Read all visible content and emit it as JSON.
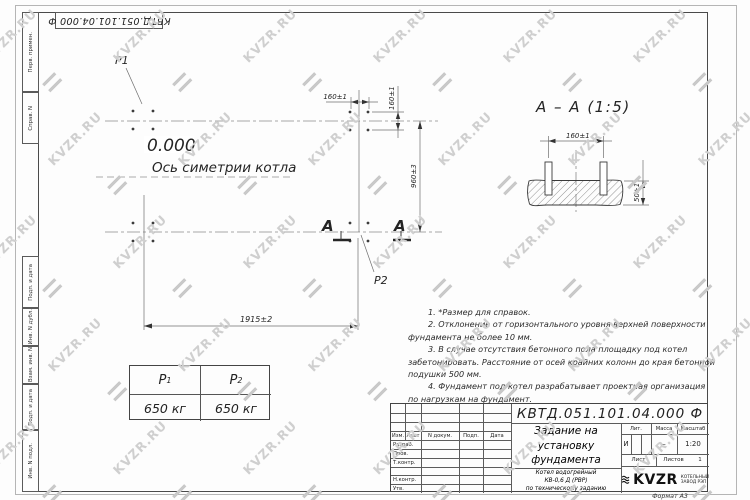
{
  "colors": {
    "ink": "#3a3a3a",
    "frame": "#4a4a4a",
    "watermark": "#cfcfcf"
  },
  "watermark": {
    "text": "KVZR.RU"
  },
  "top_stamp": {
    "text": "КВТД.051.101.04.000 Ф"
  },
  "margin_labels": {
    "perv_primen": "Перв. примен.",
    "sprav_n": "Справ. N",
    "podp_i_data_upper": "Подп. и дата",
    "inv_n_dubl": "Инв. N дубл.",
    "vzam_inv_n": "Взам. инв. N",
    "podp_i_data_lower": "Подп. и дата",
    "inv_n_podl": "Инв. N подл."
  },
  "plan": {
    "load_point_1": "P1",
    "load_point_2": "P2",
    "level_mark": "0.000",
    "symmetry_axis_label": "Ось симетрии котла",
    "dim_bolt_spacing_h": "160±1",
    "dim_bolt_spacing_v": "160±1",
    "dim_width": "960±3",
    "dim_length": "1915±2",
    "section_letter_left": "A",
    "section_letter_right": "A"
  },
  "section_view": {
    "title": "А – А (1:5)",
    "dim_bolt_spacing": "160±1",
    "dim_depth": "50±1"
  },
  "notes": {
    "lines": [
      "1. *Размер для справок.",
      "2. Отклонение от горизонтального уровня верхней поверхности",
      "фундамента не более 10 мм.",
      "3. В случае отсутствия бетонного пола площадку под котел",
      "забетонировать. Расстояние от осей крайних колонн до края бетонной",
      "подушки 500 мм.",
      "4. Фундамент под котел разрабатывает проектная организация",
      "по нагрузкам на фундамент."
    ]
  },
  "load_table": {
    "headers": [
      {
        "base": "P",
        "sub": "1"
      },
      {
        "base": "P",
        "sub": "2"
      }
    ],
    "values": [
      "650 кг",
      "650 кг"
    ]
  },
  "title_block": {
    "designation": "КВТД.051.101.04.000 Ф",
    "title_lines": [
      "Задание на",
      "установку",
      "фундамента"
    ],
    "subtitle_lines": [
      "Котел водогрейный",
      "КВ-0,6 Д (РВР)",
      "по техническому заданию"
    ],
    "header_cells": [
      "Изм.",
      "Лист",
      "N докум.",
      "Подп.",
      "Дата"
    ],
    "approval_rows": [
      "Разраб.",
      "Пров.",
      "Т.контр.",
      "Н.контр.",
      "Утв."
    ],
    "lit_header": "Лит.",
    "mass_header": "Масса",
    "scale_header": "Масштаб",
    "lit_value": "И",
    "mass_value": "–",
    "scale_value": "1:20",
    "sheet_label": "Лист",
    "sheets_label": "Листов",
    "sheets_value": "1",
    "logo_text": "KVZR",
    "logo_caption_lines": [
      "КОТЕЛЬНЫЙ",
      "ЗАВОД РЭП"
    ],
    "format_label": "Формат А3"
  }
}
